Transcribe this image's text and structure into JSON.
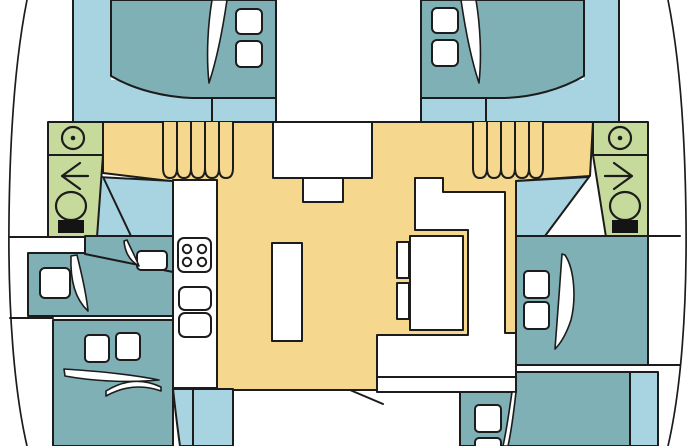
{
  "diagram": {
    "type": "catamaran-floor-plan-top-view",
    "rooms": [
      "bow-cabin-port",
      "bow-cabin-starboard",
      "bathroom-port",
      "bathroom-starboard",
      "cockpit-walkway",
      "salon",
      "galley",
      "mid-cabin-port",
      "aft-cabin-port",
      "mid-cabin-starboard",
      "aft-cabin-starboard"
    ]
  },
  "colors": {
    "background": "#ffffff",
    "outline": "#1c1c1c",
    "deck": "#f5d78e",
    "bed": "#7fb0b5",
    "floor": "#a8d3e0",
    "bathroom": "#c6da9b",
    "white": "#ffffff",
    "seat": "#141414"
  },
  "icons": {
    "shower": "circle-with-dot",
    "toilet": "bowl-with-black-seat",
    "door_swing": "sail-arc",
    "stairs": "ribbed-steps",
    "stove": "four-burner-hob",
    "sink": "rounded-basin",
    "door_direction_port": "arrow-left",
    "door_direction_starboard": "arrow-right"
  }
}
